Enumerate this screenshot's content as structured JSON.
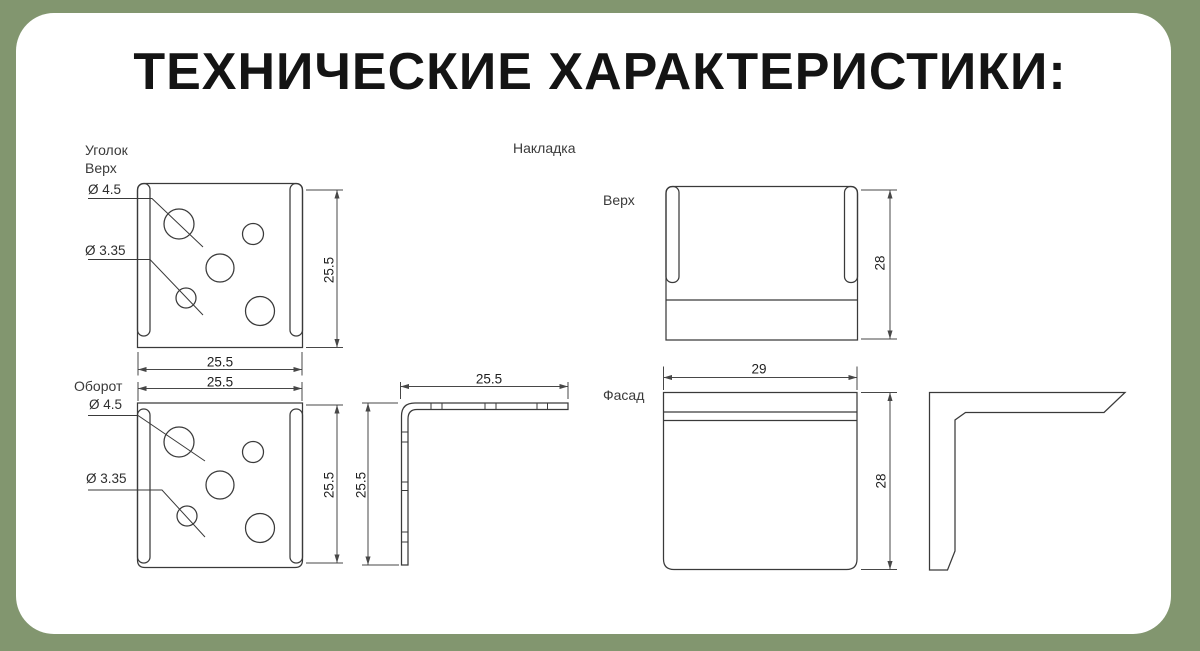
{
  "title": "ТЕХНИЧЕСКИЕ ХАРАКТЕРИСТИКИ:",
  "colors": {
    "frame_green": "#82966f",
    "card_white": "#ffffff",
    "line_gray": "#3a3a3a"
  },
  "ugolok": {
    "name": "Уголок",
    "top_view": {
      "label": "Верх",
      "dia_large": "Ø 4.5",
      "dia_small": "Ø 3.35",
      "width": "25.5",
      "height": "25.5"
    },
    "back_view": {
      "label": "Оборот",
      "dia_large": "Ø 4.5",
      "dia_small": "Ø 3.35",
      "width": "25.5",
      "height": "25.5"
    },
    "side_view": {
      "width": "25.5",
      "height": "25.5"
    }
  },
  "nakladka": {
    "name": "Накладка",
    "top_view": {
      "label": "Верх",
      "height": "28"
    },
    "front_view": {
      "label": "Фасад",
      "width": "29",
      "height": "28"
    }
  }
}
